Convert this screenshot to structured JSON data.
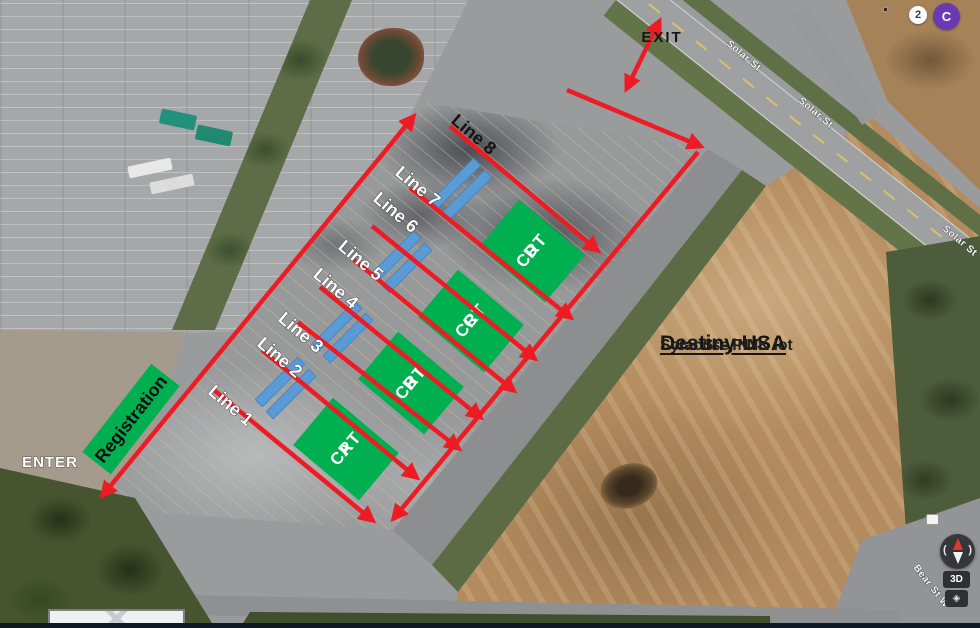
{
  "overlay": {
    "exit_label": "EXIT",
    "enter_label": "ENTER",
    "registration_label": "Registration",
    "lines": [
      "Line 1",
      "Line 2",
      "Line 3",
      "Line 4",
      "Line 5",
      "Line 6",
      "Line 7",
      "Line 8"
    ],
    "crt_boxes": [
      {
        "title": "CRT",
        "letter": "A"
      },
      {
        "title": "CRT",
        "letter": "B"
      },
      {
        "title": "CRT",
        "letter": "C"
      },
      {
        "title": "CRT",
        "letter": "D"
      }
    ],
    "location": {
      "title": "Destiny USA",
      "line1": "Solar St - PINK lot",
      "line2": "Syracuse, NY"
    },
    "colors": {
      "box_green": "#00B050",
      "arrow_red": "#ED1C24",
      "bar_blue": "#5B9BD5"
    }
  },
  "map": {
    "street_labels": [
      "Solar St",
      "Solar St",
      "Solar St",
      "Bear St W"
    ]
  },
  "topbar": {
    "notification_count": "2",
    "avatar_initial": "C"
  },
  "controls": {
    "threed_label": "3D",
    "diamond_glyph": "◈"
  },
  "icons": {
    "apps_grid": "3x3-dot-grid",
    "compass": "red-north-needle-compass",
    "view_toggle": "diamond"
  }
}
